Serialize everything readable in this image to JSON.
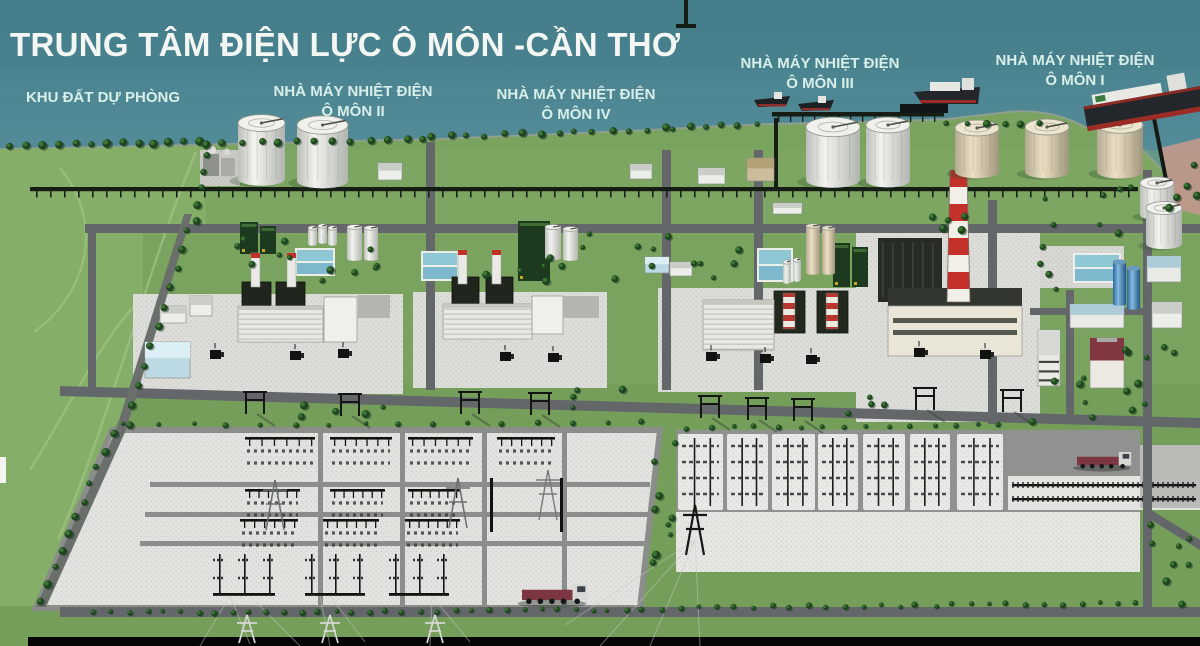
{
  "title": "TRUNG TÂM ĐIỆN LỰC Ô MÔN -CẦN THƠ",
  "areas": [
    {
      "name": "reserve-land",
      "line1": "KHU ĐẤT DỰ PHÒNG",
      "line2": ""
    },
    {
      "name": "omon-2",
      "line1": "NHÀ MÁY NHIỆT ĐIỆN",
      "line2": "Ô MÔN II"
    },
    {
      "name": "omon-4",
      "line1": "NHÀ MÁY NHIỆT ĐIỆN",
      "line2": "Ô MÔN IV"
    },
    {
      "name": "omon-3",
      "line1": "NHÀ MÁY NHIỆT ĐIỆN",
      "line2": "Ô MÔN III"
    },
    {
      "name": "omon-1",
      "line1": "NHÀ MÁY NHIỆT ĐIỆN",
      "line2": "Ô MÔN I"
    }
  ],
  "colors": {
    "title_text": "#f3f6f2",
    "label_text": "#d8efe9",
    "water": "#4e8894",
    "land": "#77a15c",
    "gravel": "#dddeda",
    "chimney_red": "#c23126",
    "truck_red": "#7b3642"
  }
}
